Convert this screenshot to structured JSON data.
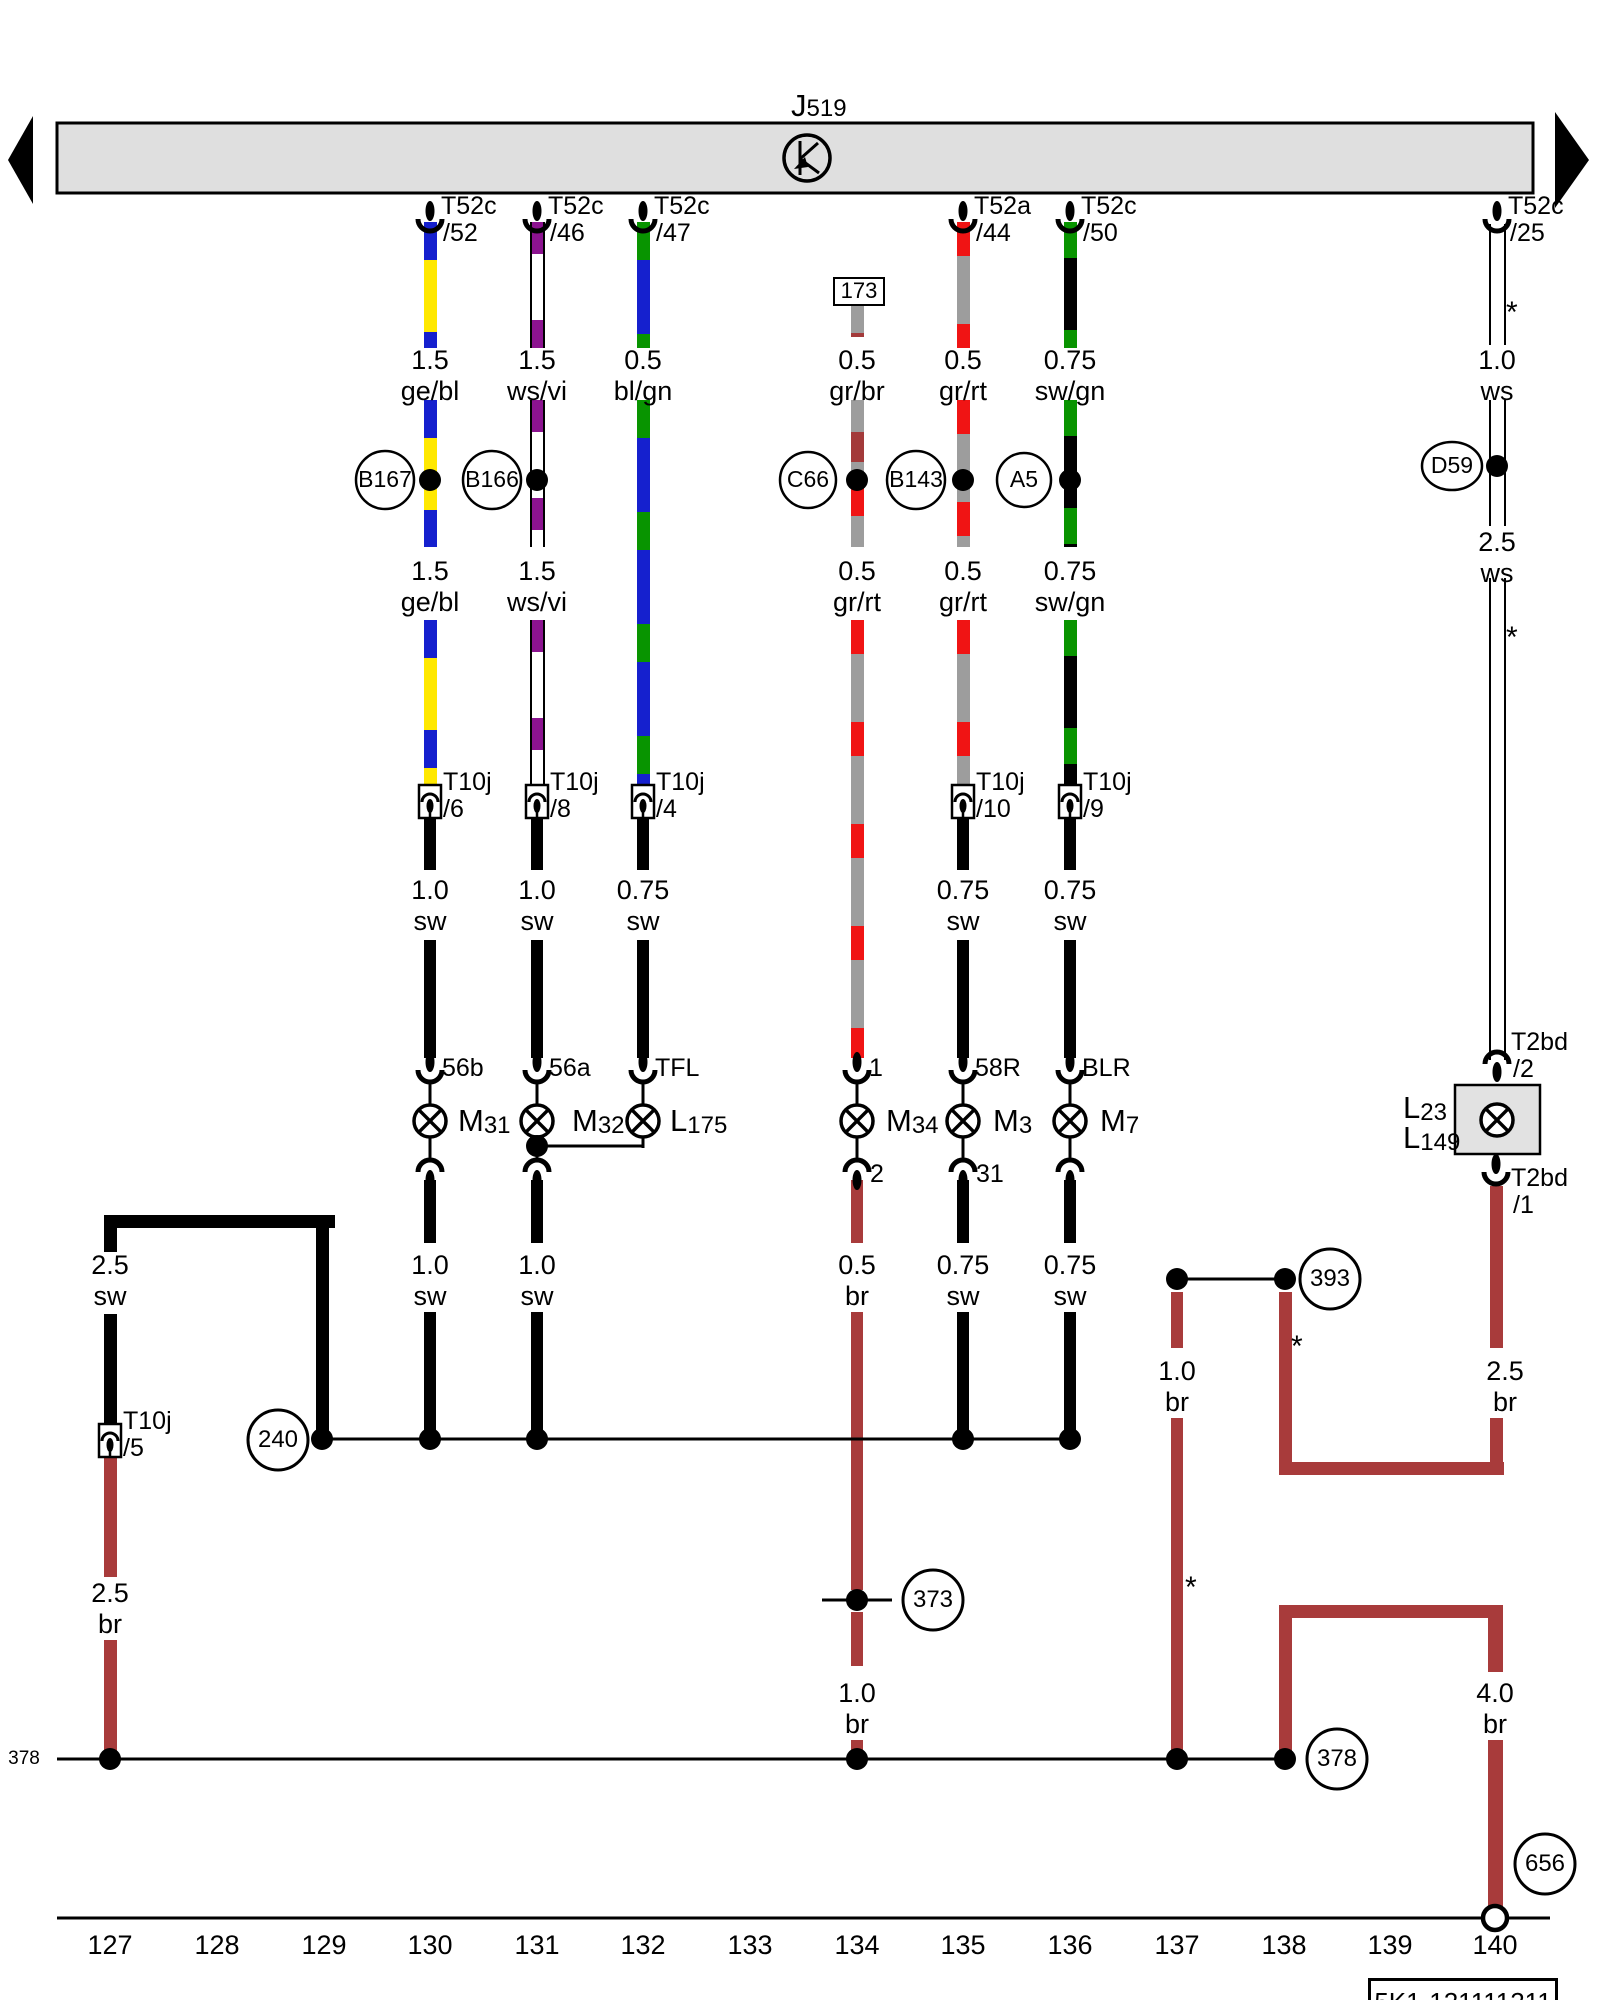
{
  "header": {
    "component_prefix": "J",
    "component_number": "519",
    "bar": {
      "x": 57,
      "y": 123,
      "w": 1476,
      "h": 70,
      "fill": "#dfdfdf"
    },
    "k_symbol": {
      "x": 807,
      "y": 158,
      "r": 23
    },
    "nav_left": [
      [
        8,
        160
      ],
      [
        33,
        116
      ],
      [
        33,
        204
      ]
    ],
    "nav_right": [
      [
        1589,
        160
      ],
      [
        1555,
        112
      ],
      [
        1555,
        208
      ]
    ]
  },
  "plate_id": "5K1-121111211",
  "plate_box": {
    "x": 1368,
    "y": 1978,
    "w": 184,
    "h": 40
  },
  "left_margin_ref": {
    "text": "378",
    "x": 24,
    "y": 1748
  },
  "colors": {
    "brown": "#a83b3b",
    "yellow": "#ffe800",
    "blue": "#1520ce",
    "green": "#089400",
    "violet": "#8c1390",
    "red": "#f01414",
    "gray": "#9d9d9d",
    "bar_gray": "#dfdfdf"
  },
  "terminals": [
    {
      "x": 430,
      "name": "T52c",
      "pin": "/52"
    },
    {
      "x": 537,
      "name": "T52c",
      "pin": "/46"
    },
    {
      "x": 643,
      "name": "T52c",
      "pin": "/47"
    },
    {
      "x": 963,
      "name": "T52a",
      "pin": "/44"
    },
    {
      "x": 1070,
      "name": "T52c",
      "pin": "/50"
    },
    {
      "x": 1497,
      "name": "T52c",
      "pin": "/25"
    }
  ],
  "wire_segments": [
    {
      "x": 430,
      "y": 222,
      "h": 126,
      "cls": "gebl",
      "w": 13
    },
    {
      "x": 430,
      "y": 400,
      "h": 147,
      "cls": "gebl",
      "w": 13
    },
    {
      "x": 430,
      "y": 620,
      "h": 165,
      "cls": "gebl",
      "w": 13
    },
    {
      "x": 430,
      "y": 818,
      "h": 52,
      "cls": "sw",
      "w": 12
    },
    {
      "x": 430,
      "y": 940,
      "h": 118,
      "cls": "sw",
      "w": 12
    },
    {
      "x": 430,
      "y": 1180,
      "h": 63,
      "cls": "sw",
      "w": 12
    },
    {
      "x": 430,
      "y": 1312,
      "h": 128,
      "cls": "sw",
      "w": 12
    },
    {
      "x": 537,
      "y": 222,
      "h": 126,
      "cls": "wsvi",
      "w": 15
    },
    {
      "x": 537,
      "y": 400,
      "h": 147,
      "cls": "wsvi",
      "w": 15
    },
    {
      "x": 537,
      "y": 620,
      "h": 165,
      "cls": "wsvi",
      "w": 15
    },
    {
      "x": 537,
      "y": 818,
      "h": 52,
      "cls": "sw",
      "w": 12
    },
    {
      "x": 537,
      "y": 940,
      "h": 118,
      "cls": "sw",
      "w": 12
    },
    {
      "x": 537,
      "y": 1180,
      "h": 63,
      "cls": "sw",
      "w": 12
    },
    {
      "x": 537,
      "y": 1312,
      "h": 128,
      "cls": "sw",
      "w": 12
    },
    {
      "x": 643,
      "y": 222,
      "h": 126,
      "cls": "blgn",
      "w": 13
    },
    {
      "x": 643,
      "y": 400,
      "h": 385,
      "cls": "blgn",
      "w": 13
    },
    {
      "x": 643,
      "y": 818,
      "h": 52,
      "cls": "sw",
      "w": 12
    },
    {
      "x": 643,
      "y": 940,
      "h": 118,
      "cls": "sw",
      "w": 12
    },
    {
      "x": 857,
      "y": 301,
      "h": 36,
      "cls": "grbr",
      "w": 13
    },
    {
      "x": 857,
      "y": 400,
      "h": 82,
      "cls": "grbr",
      "w": 13
    },
    {
      "x": 857,
      "y": 482,
      "h": 65,
      "cls": "grrt",
      "w": 13
    },
    {
      "x": 857,
      "y": 620,
      "h": 438,
      "cls": "grrt",
      "w": 13
    },
    {
      "x": 857,
      "y": 1180,
      "h": 63,
      "cls": "br",
      "w": 12
    },
    {
      "x": 857,
      "y": 1312,
      "h": 278,
      "cls": "br",
      "w": 12
    },
    {
      "x": 857,
      "y": 1612,
      "h": 54,
      "cls": "br",
      "w": 12
    },
    {
      "x": 857,
      "y": 1740,
      "h": 20,
      "cls": "br",
      "w": 12
    },
    {
      "x": 963,
      "y": 222,
      "h": 126,
      "cls": "grrt",
      "w": 13
    },
    {
      "x": 963,
      "y": 400,
      "h": 147,
      "cls": "grrt",
      "w": 13
    },
    {
      "x": 963,
      "y": 620,
      "h": 165,
      "cls": "grrt",
      "w": 13
    },
    {
      "x": 963,
      "y": 818,
      "h": 52,
      "cls": "sw",
      "w": 12
    },
    {
      "x": 963,
      "y": 940,
      "h": 118,
      "cls": "sw",
      "w": 12
    },
    {
      "x": 963,
      "y": 1180,
      "h": 63,
      "cls": "sw",
      "w": 12
    },
    {
      "x": 963,
      "y": 1312,
      "h": 128,
      "cls": "sw",
      "w": 12
    },
    {
      "x": 1070,
      "y": 222,
      "h": 126,
      "cls": "swgn",
      "w": 13
    },
    {
      "x": 1070,
      "y": 400,
      "h": 147,
      "cls": "swgn",
      "w": 13
    },
    {
      "x": 1070,
      "y": 620,
      "h": 165,
      "cls": "swgn",
      "w": 13
    },
    {
      "x": 1070,
      "y": 818,
      "h": 52,
      "cls": "sw",
      "w": 12
    },
    {
      "x": 1070,
      "y": 940,
      "h": 118,
      "cls": "sw",
      "w": 12
    },
    {
      "x": 1070,
      "y": 1180,
      "h": 63,
      "cls": "sw",
      "w": 12
    },
    {
      "x": 1070,
      "y": 1312,
      "h": 128,
      "cls": "sw",
      "w": 12
    },
    {
      "x": 1497,
      "y": 224,
      "h": 121,
      "cls": "ws",
      "w": 17
    },
    {
      "x": 1497,
      "y": 400,
      "h": 126,
      "cls": "ws",
      "w": 17
    },
    {
      "x": 1497,
      "y": 578,
      "h": 482,
      "cls": "ws",
      "w": 17
    },
    {
      "x": 1496,
      "y": 1186,
      "h": 162,
      "cls": "br",
      "w": 13
    },
    {
      "x": 1496,
      "y": 1418,
      "h": 57,
      "cls": "br",
      "w": 13
    },
    {
      "x": 1285,
      "y": 1292,
      "h": 183,
      "cls": "br",
      "w": 13
    },
    {
      "kind": "h",
      "x": 1279,
      "y": 1462,
      "len": 225,
      "cls": "br",
      "w": 13
    },
    {
      "x": 1177,
      "y": 1292,
      "h": 56,
      "cls": "br",
      "w": 12
    },
    {
      "x": 1177,
      "y": 1418,
      "h": 345,
      "cls": "br",
      "w": 12
    },
    {
      "x": 1285,
      "y": 1612,
      "h": 140,
      "cls": "br",
      "w": 13
    },
    {
      "kind": "h",
      "x": 1279,
      "y": 1605,
      "len": 224,
      "cls": "br",
      "w": 13
    },
    {
      "x": 1495,
      "y": 1605,
      "h": 67,
      "cls": "br",
      "w": 15
    },
    {
      "x": 1495,
      "y": 1740,
      "h": 170,
      "cls": "br",
      "w": 15
    },
    {
      "kind": "h",
      "x": 104,
      "y": 1215,
      "len": 231,
      "cls": "sw",
      "w": 13
    },
    {
      "x": 110,
      "y": 1228,
      "h": 24,
      "cls": "sw",
      "w": 13
    },
    {
      "x": 322,
      "y": 1228,
      "h": 214,
      "cls": "sw",
      "w": 13
    },
    {
      "x": 110,
      "y": 1314,
      "h": 112,
      "cls": "sw",
      "w": 13
    },
    {
      "x": 110,
      "y": 1457,
      "h": 120,
      "cls": "br",
      "w": 13
    },
    {
      "x": 110,
      "y": 1640,
      "h": 120,
      "cls": "br",
      "w": 13
    }
  ],
  "thin_lines": [
    {
      "x1": 322,
      "y1": 1439,
      "x2": 1070,
      "y2": 1439
    },
    {
      "x1": 57,
      "y1": 1759,
      "x2": 1285,
      "y2": 1759
    },
    {
      "x1": 1177,
      "y1": 1279,
      "x2": 1285,
      "y2": 1279
    },
    {
      "x1": 822,
      "y1": 1600,
      "x2": 892,
      "y2": 1600
    },
    {
      "x1": 537,
      "y1": 1146,
      "x2": 643,
      "y2": 1146
    },
    {
      "x1": 643,
      "y1": 1133,
      "x2": 643,
      "y2": 1148
    },
    {
      "x1": 57,
      "y1": 1918,
      "x2": 1550,
      "y2": 1918
    },
    {
      "x1": 1497,
      "y1": 1086,
      "x2": 1497,
      "y2": 1108
    },
    {
      "x1": 1497,
      "y1": 1134,
      "x2": 1497,
      "y2": 1156
    }
  ],
  "junction_dots": [
    {
      "x": 430,
      "y": 480
    },
    {
      "x": 537,
      "y": 480
    },
    {
      "x": 857,
      "y": 480
    },
    {
      "x": 963,
      "y": 480
    },
    {
      "x": 1070,
      "y": 480
    },
    {
      "x": 1497,
      "y": 466
    },
    {
      "x": 537,
      "y": 1146
    },
    {
      "x": 322,
      "y": 1439
    },
    {
      "x": 430,
      "y": 1439
    },
    {
      "x": 537,
      "y": 1439
    },
    {
      "x": 963,
      "y": 1439
    },
    {
      "x": 1070,
      "y": 1439
    },
    {
      "x": 857,
      "y": 1600
    },
    {
      "x": 110,
      "y": 1759
    },
    {
      "x": 857,
      "y": 1759
    },
    {
      "x": 1177,
      "y": 1759
    },
    {
      "x": 1285,
      "y": 1759
    },
    {
      "x": 1177,
      "y": 1279
    },
    {
      "x": 1285,
      "y": 1279
    }
  ],
  "ref_circles": [
    {
      "label": "B167",
      "x": 385,
      "y": 480,
      "rx": 29,
      "ry": 29
    },
    {
      "label": "B166",
      "x": 492,
      "y": 480,
      "rx": 29,
      "ry": 29
    },
    {
      "label": "C66",
      "x": 808,
      "y": 480,
      "rx": 28,
      "ry": 28
    },
    {
      "label": "B143",
      "x": 916,
      "y": 480,
      "rx": 29,
      "ry": 29
    },
    {
      "label": "A5",
      "x": 1024,
      "y": 480,
      "rx": 27,
      "ry": 27
    },
    {
      "label": "D59",
      "x": 1452,
      "y": 466,
      "rx": 30,
      "ry": 24
    }
  ],
  "xref_circles": [
    {
      "label": "240",
      "x": 278,
      "y": 1440,
      "r": 30
    },
    {
      "label": "373",
      "x": 933,
      "y": 1600,
      "r": 30
    },
    {
      "label": "393",
      "x": 1330,
      "y": 1279,
      "r": 30
    },
    {
      "label": "378",
      "x": 1337,
      "y": 1759,
      "r": 30
    },
    {
      "label": "656",
      "x": 1545,
      "y": 1864,
      "r": 30
    }
  ],
  "bulbs": [
    {
      "x": 430,
      "y": 1121,
      "prefix": "M",
      "number": "31",
      "lx": 458
    },
    {
      "x": 537,
      "y": 1121,
      "prefix": "M",
      "number": "32",
      "lx": 572
    },
    {
      "x": 643,
      "y": 1121,
      "prefix": "L",
      "number": "175",
      "lx": 670
    },
    {
      "x": 857,
      "y": 1121,
      "prefix": "M",
      "number": "34",
      "lx": 886
    },
    {
      "x": 963,
      "y": 1121,
      "prefix": "M",
      "number": "3",
      "lx": 993
    },
    {
      "x": 1070,
      "y": 1121,
      "prefix": "M",
      "number": "7",
      "lx": 1100
    }
  ],
  "sockets_top": [
    {
      "x": 430,
      "label": "56b"
    },
    {
      "x": 537,
      "label": "56a"
    },
    {
      "x": 643,
      "label": "TFL"
    },
    {
      "x": 857,
      "label": "1"
    },
    {
      "x": 963,
      "label": "58R"
    },
    {
      "x": 1070,
      "label": "BLR"
    }
  ],
  "sockets_bottom": [
    {
      "x": 430,
      "label": ""
    },
    {
      "x": 537,
      "label": ""
    },
    {
      "x": 857,
      "label": "2"
    },
    {
      "x": 963,
      "label": "31"
    },
    {
      "x": 1070,
      "label": ""
    }
  ],
  "t10j_connectors": [
    {
      "x": 430,
      "y": 785,
      "name": "T10j",
      "pin": "/6"
    },
    {
      "x": 537,
      "y": 785,
      "name": "T10j",
      "pin": "/8"
    },
    {
      "x": 643,
      "y": 785,
      "name": "T10j",
      "pin": "/4"
    },
    {
      "x": 963,
      "y": 785,
      "name": "T10j",
      "pin": "/10"
    },
    {
      "x": 1070,
      "y": 785,
      "name": "T10j",
      "pin": "/9"
    },
    {
      "x": 110,
      "y": 1424,
      "name": "T10j",
      "pin": "/5"
    }
  ],
  "gauge_labels": [
    {
      "x": 430,
      "y": 346,
      "gauge": "1.5",
      "color": "ge/bl"
    },
    {
      "x": 537,
      "y": 346,
      "gauge": "1.5",
      "color": "ws/vi"
    },
    {
      "x": 643,
      "y": 346,
      "gauge": "0.5",
      "color": "bl/gn"
    },
    {
      "x": 857,
      "y": 346,
      "gauge": "0.5",
      "color": "gr/br"
    },
    {
      "x": 963,
      "y": 346,
      "gauge": "0.5",
      "color": "gr/rt"
    },
    {
      "x": 1070,
      "y": 346,
      "gauge": "0.75",
      "color": "sw/gn"
    },
    {
      "x": 1497,
      "y": 346,
      "gauge": "1.0",
      "color": "ws"
    },
    {
      "x": 430,
      "y": 557,
      "gauge": "1.5",
      "color": "ge/bl"
    },
    {
      "x": 537,
      "y": 557,
      "gauge": "1.5",
      "color": "ws/vi"
    },
    {
      "x": 857,
      "y": 557,
      "gauge": "0.5",
      "color": "gr/rt"
    },
    {
      "x": 963,
      "y": 557,
      "gauge": "0.5",
      "color": "gr/rt"
    },
    {
      "x": 1070,
      "y": 557,
      "gauge": "0.75",
      "color": "sw/gn"
    },
    {
      "x": 1497,
      "y": 528,
      "gauge": "2.5",
      "color": "ws"
    },
    {
      "x": 430,
      "y": 876,
      "gauge": "1.0",
      "color": "sw"
    },
    {
      "x": 537,
      "y": 876,
      "gauge": "1.0",
      "color": "sw"
    },
    {
      "x": 643,
      "y": 876,
      "gauge": "0.75",
      "color": "sw"
    },
    {
      "x": 963,
      "y": 876,
      "gauge": "0.75",
      "color": "sw"
    },
    {
      "x": 1070,
      "y": 876,
      "gauge": "0.75",
      "color": "sw"
    },
    {
      "x": 110,
      "y": 1251,
      "gauge": "2.5",
      "color": "sw"
    },
    {
      "x": 430,
      "y": 1251,
      "gauge": "1.0",
      "color": "sw"
    },
    {
      "x": 537,
      "y": 1251,
      "gauge": "1.0",
      "color": "sw"
    },
    {
      "x": 857,
      "y": 1251,
      "gauge": "0.5",
      "color": "br"
    },
    {
      "x": 963,
      "y": 1251,
      "gauge": "0.75",
      "color": "sw"
    },
    {
      "x": 1070,
      "y": 1251,
      "gauge": "0.75",
      "color": "sw"
    },
    {
      "x": 1177,
      "y": 1357,
      "gauge": "1.0",
      "color": "br"
    },
    {
      "x": 1505,
      "y": 1357,
      "gauge": "2.5",
      "color": "br"
    },
    {
      "x": 110,
      "y": 1579,
      "gauge": "2.5",
      "color": "br"
    },
    {
      "x": 857,
      "y": 1679,
      "gauge": "1.0",
      "color": "br"
    },
    {
      "x": 1495,
      "y": 1679,
      "gauge": "4.0",
      "color": "br"
    }
  ],
  "stars": [
    {
      "x": 1506,
      "y": 296
    },
    {
      "x": 1506,
      "y": 621
    },
    {
      "x": 1291,
      "y": 1330
    },
    {
      "x": 1185,
      "y": 1571
    }
  ],
  "id_box": {
    "x": 833,
    "y": 277,
    "w": 48,
    "h": 25,
    "label": "173"
  },
  "lamp_box": {
    "x": 1455,
    "y": 1085,
    "w": 85,
    "h": 69,
    "bulb_x": 1497,
    "bulb_y": 1120,
    "labels": [
      {
        "prefix": "L",
        "number": "23"
      },
      {
        "prefix": "L",
        "number": "149"
      }
    ],
    "top_terminal": {
      "name": "T2bd",
      "pin": "/2"
    },
    "bottom_terminal": {
      "name": "T2bd",
      "pin": "/1"
    }
  },
  "ground": {
    "x": 1495,
    "y": 1918
  },
  "track_numbers": [
    {
      "label": "127",
      "x": 110
    },
    {
      "label": "128",
      "x": 217
    },
    {
      "label": "129",
      "x": 324
    },
    {
      "label": "130",
      "x": 430
    },
    {
      "label": "131",
      "x": 537
    },
    {
      "label": "132",
      "x": 643
    },
    {
      "label": "133",
      "x": 750
    },
    {
      "label": "134",
      "x": 857
    },
    {
      "label": "135",
      "x": 963
    },
    {
      "label": "136",
      "x": 1070
    },
    {
      "label": "137",
      "x": 1177
    },
    {
      "label": "138",
      "x": 1284
    },
    {
      "label": "139",
      "x": 1390
    },
    {
      "label": "140",
      "x": 1495
    }
  ]
}
